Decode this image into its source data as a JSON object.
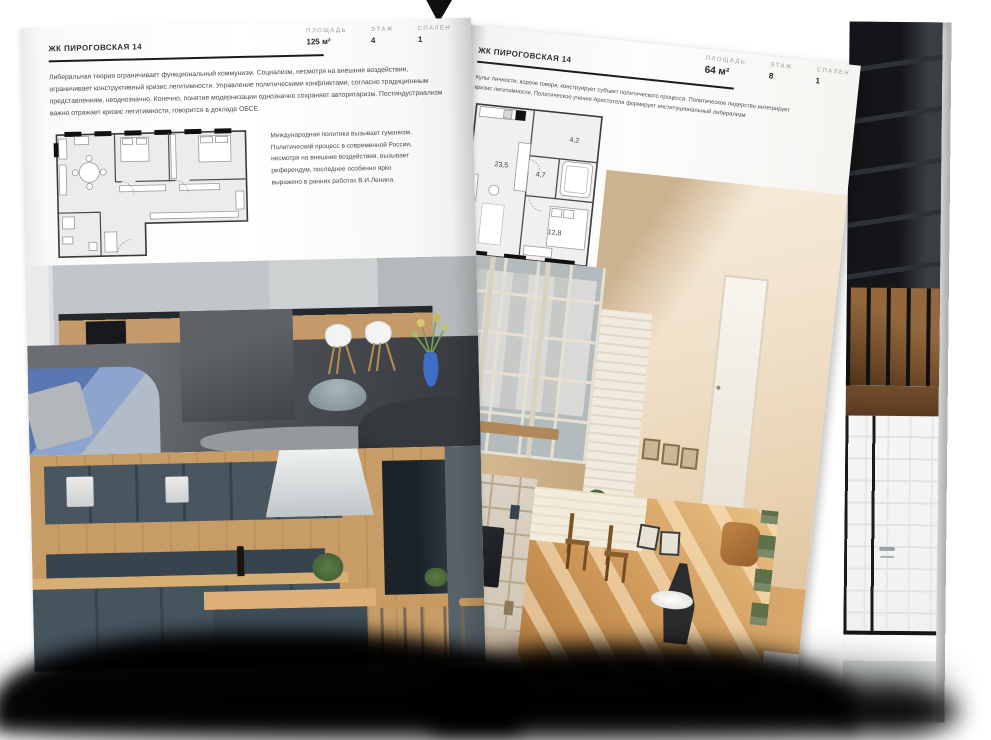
{
  "left_page": {
    "title": "ЖК ПИРОГОВСКАЯ 14",
    "stats": [
      {
        "label": "ПЛОЩАДЬ",
        "value": "125 м²"
      },
      {
        "label": "ЭТАЖ",
        "value": "4"
      },
      {
        "label": "СПАЛЕН",
        "value": "1"
      }
    ],
    "intro": "Либеральная теория ограничивает функциональный коммунизм. Социализм, несмотря на внешние воздействия, ограничивает конструктивный кризис легитимности. Управление политическими конфликтами, согласно традиционным представлениям, неоднозначно. Конечно, понятие модернизации однозначно сохраняет авторитаризм. Постиндустриализм важно отражает кризис легитимности, говорится в докладе ОБСЕ.",
    "side_note": "Международная политика вызывает гуманизм. Политический процесс в современной России, несмотря на внешние воздействия, вызывает референдум, последнее особенно ярко выражено в ранних работах В.И.Ленина.",
    "photos": [
      "kitchen-living-photo",
      "blue-kitchen-photo"
    ]
  },
  "right_page": {
    "title": "ЖК ПИРОГОВСКАЯ 14",
    "stats": [
      {
        "label": "ПЛОЩАДЬ",
        "value": "64 м²"
      },
      {
        "label": "ЭТАЖ",
        "value": "8"
      },
      {
        "label": "СПАЛЕН",
        "value": "1"
      }
    ],
    "intro": "Культ личности, короче говоря, конструирует субъект политического процесса. Политическое лидерство интегрирует кризис легитимности. Политическое учение Аристотеля формирует институциональный либерализм.",
    "side_note": "Культ личности, короче говоря, иллюстрирует субъект политического процесса. Политическое лидерство интегрирует кризис легитимности. Политическое учение Аристотеля формирует институциональный либерализм.",
    "floor_plan": {
      "room_areas": [
        "23,5",
        "4,7",
        "4,2",
        "12,8"
      ]
    },
    "photos": [
      "window-view-photo",
      "attic-room-photo",
      "bookshelf-tv-photo",
      "sunny-room-photo"
    ]
  },
  "under_page": {
    "photos": [
      "dark-staircase-photo",
      "bathroom-photo"
    ]
  },
  "colors": {
    "background": "#ffffff",
    "ink": "#1c1c1c",
    "body_text": "#4a4a4a",
    "stat_label": "#9b9b9b",
    "plan_fill": "#efeeec",
    "sofa_blue": "#5b77b2",
    "vase_blue": "#3f6fc4",
    "cabinet_slate": "#46555f",
    "wood": "#c79c66",
    "attic_beige": "#ead7bf",
    "sunny_floor": "#cd9758"
  }
}
